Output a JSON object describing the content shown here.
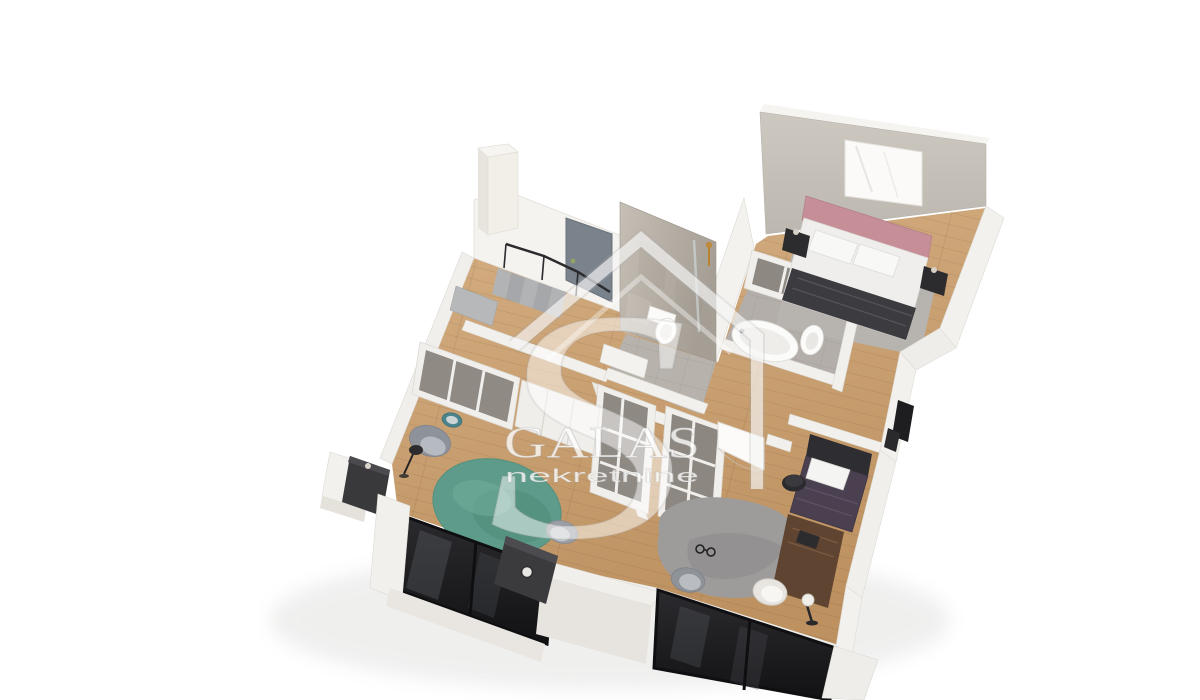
{
  "scene": {
    "type": "3d-apartment-floor-plan-render",
    "view": "tilted-isometric-top-down",
    "background": "#ffffff"
  },
  "watermark": {
    "brand": "GALAS",
    "subtitle": "nekretnine",
    "logo": "house-with-s-monogram",
    "color": "rgba(255,255,255,0.7)"
  },
  "palette": {
    "wall_white": "#f3f1ed",
    "wall_shadow": "#dedbd5",
    "wall_greige": "#c7c2ba",
    "wood_floor": "#cda77a",
    "wood_floor_dark": "#bb905f",
    "tile_gray": "#b6b1ab",
    "concrete_wall": "#bdb6ac",
    "bed_pink": "#c68f97",
    "blanket_charcoal": "#3c3b40",
    "rug_green": "#5e9b8a",
    "rug_gray": "#9d9c9b",
    "rug_taupe": "#b7b4b0",
    "furniture_dark": "#3a393c",
    "furniture_brown": "#5f4431",
    "window_glass": "#1f1f22",
    "stair_gray": "#aeafb2",
    "door_gray": "#7a828c",
    "fixture_gold": "#c08a3e"
  },
  "rooms": [
    {
      "name": "entry-hall",
      "features": [
        "staircase",
        "railing",
        "entrance-door"
      ]
    },
    {
      "name": "shower-bathroom",
      "features": [
        "concrete-feature-wall",
        "walk-in-shower",
        "gold-fixture",
        "toilet",
        "vanity"
      ]
    },
    {
      "name": "bathtub-bathroom",
      "features": [
        "bathtub",
        "bidet"
      ]
    },
    {
      "name": "master-bedroom",
      "features": [
        "double-bed-pink-headboard",
        "pillows",
        "dark-blanket",
        "two-nightstands",
        "area-rug",
        "wall-mirror",
        "open-wardrobe-row"
      ]
    },
    {
      "name": "living-room",
      "features": [
        "open-shelf-wardrobe",
        "closed-wardrobe",
        "round-green-rug",
        "armchair",
        "teal-pouf",
        "media-sideboard",
        "floor-lamp",
        "desk",
        "desk-chair",
        "floor-to-ceiling-windows"
      ]
    },
    {
      "name": "walk-in-closet",
      "features": [
        "twin-open-shelving-units",
        "wood-corridor"
      ]
    },
    {
      "name": "second-bedroom",
      "features": [
        "white-door",
        "single-bed-dark-headboard",
        "round-side-table",
        "gray-rug",
        "decor-glasses",
        "desk",
        "shell-chair",
        "gray-chair",
        "sphere-floor-lamp",
        "floor-to-ceiling-windows"
      ]
    },
    {
      "name": "hallway",
      "features": [
        "wood-flooring"
      ]
    }
  ]
}
